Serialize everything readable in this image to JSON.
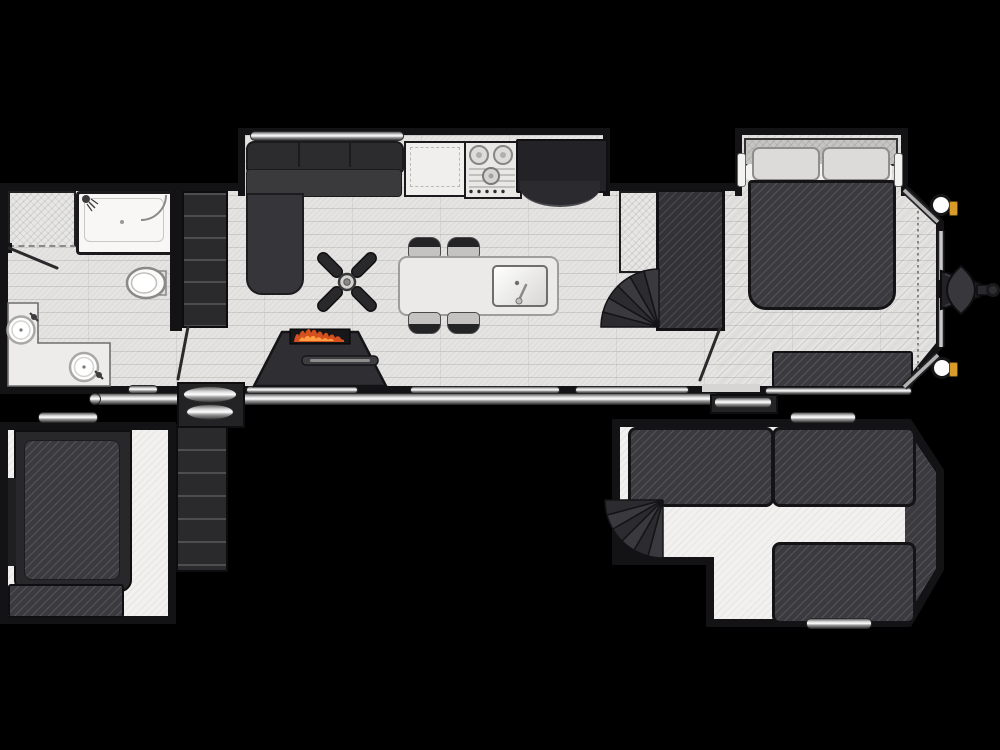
{
  "scene": {
    "type": "rv-destination-trailer-floor-plan",
    "views": [
      "main-level",
      "rear-loft",
      "front-loft"
    ],
    "background": "#000000",
    "canvas": {
      "width": 1000,
      "height": 750
    }
  },
  "palette": {
    "wall": "#131315",
    "floor_plank": "#e0dfdd",
    "floor_loft": "#f2f1ef",
    "furniture_dark": "#3b3b3f",
    "fixture_white": "#f8f7f5",
    "counter_light": "#eceae8",
    "metal_trim": "#d9d9d9",
    "flame_red": "#d4501e",
    "flame_orange": "#ff9e42",
    "marker_amber": "#d89a28"
  },
  "main_level": {
    "bathroom": {
      "fixtures": [
        "linen-closet",
        "shower",
        "toilet",
        "double-sink-vanity",
        "bathroom-door"
      ]
    },
    "living_kitchen": {
      "furniture": [
        "sectional-sofa-slideout",
        "ceiling-fan",
        "fireplace-tv-console",
        "kitchen-island-with-sink",
        "bar-stools-x4",
        "range-cooktop",
        "refrigerator",
        "pantry-cabinet"
      ]
    },
    "bedroom": {
      "furniture": [
        "queen-bed-slideout",
        "pillows-x2",
        "wardrobe",
        "dresser-bench"
      ]
    },
    "circulation": [
      "rear-loft-steps",
      "front-spiral-staircase",
      "rear-entry-door",
      "front-entry-door"
    ],
    "exterior": [
      "awning-rail",
      "rear-entry-steps",
      "front-entry-step",
      "a-frame-hitch",
      "stabilizer-jacks-x2",
      "marker-lights-x2",
      "front-cap-outline"
    ]
  },
  "rear_loft": {
    "furniture": [
      "loft-bed",
      "storage-bench",
      "loft-access-steps",
      "grab-handle"
    ]
  },
  "front_loft": {
    "furniture": [
      "loft-mattress-left",
      "loft-mattress-right",
      "loft-mattress-bottom",
      "spiral-staircase",
      "grab-handle-top",
      "grab-handle-bottom"
    ],
    "walkway": "T-shaped"
  }
}
